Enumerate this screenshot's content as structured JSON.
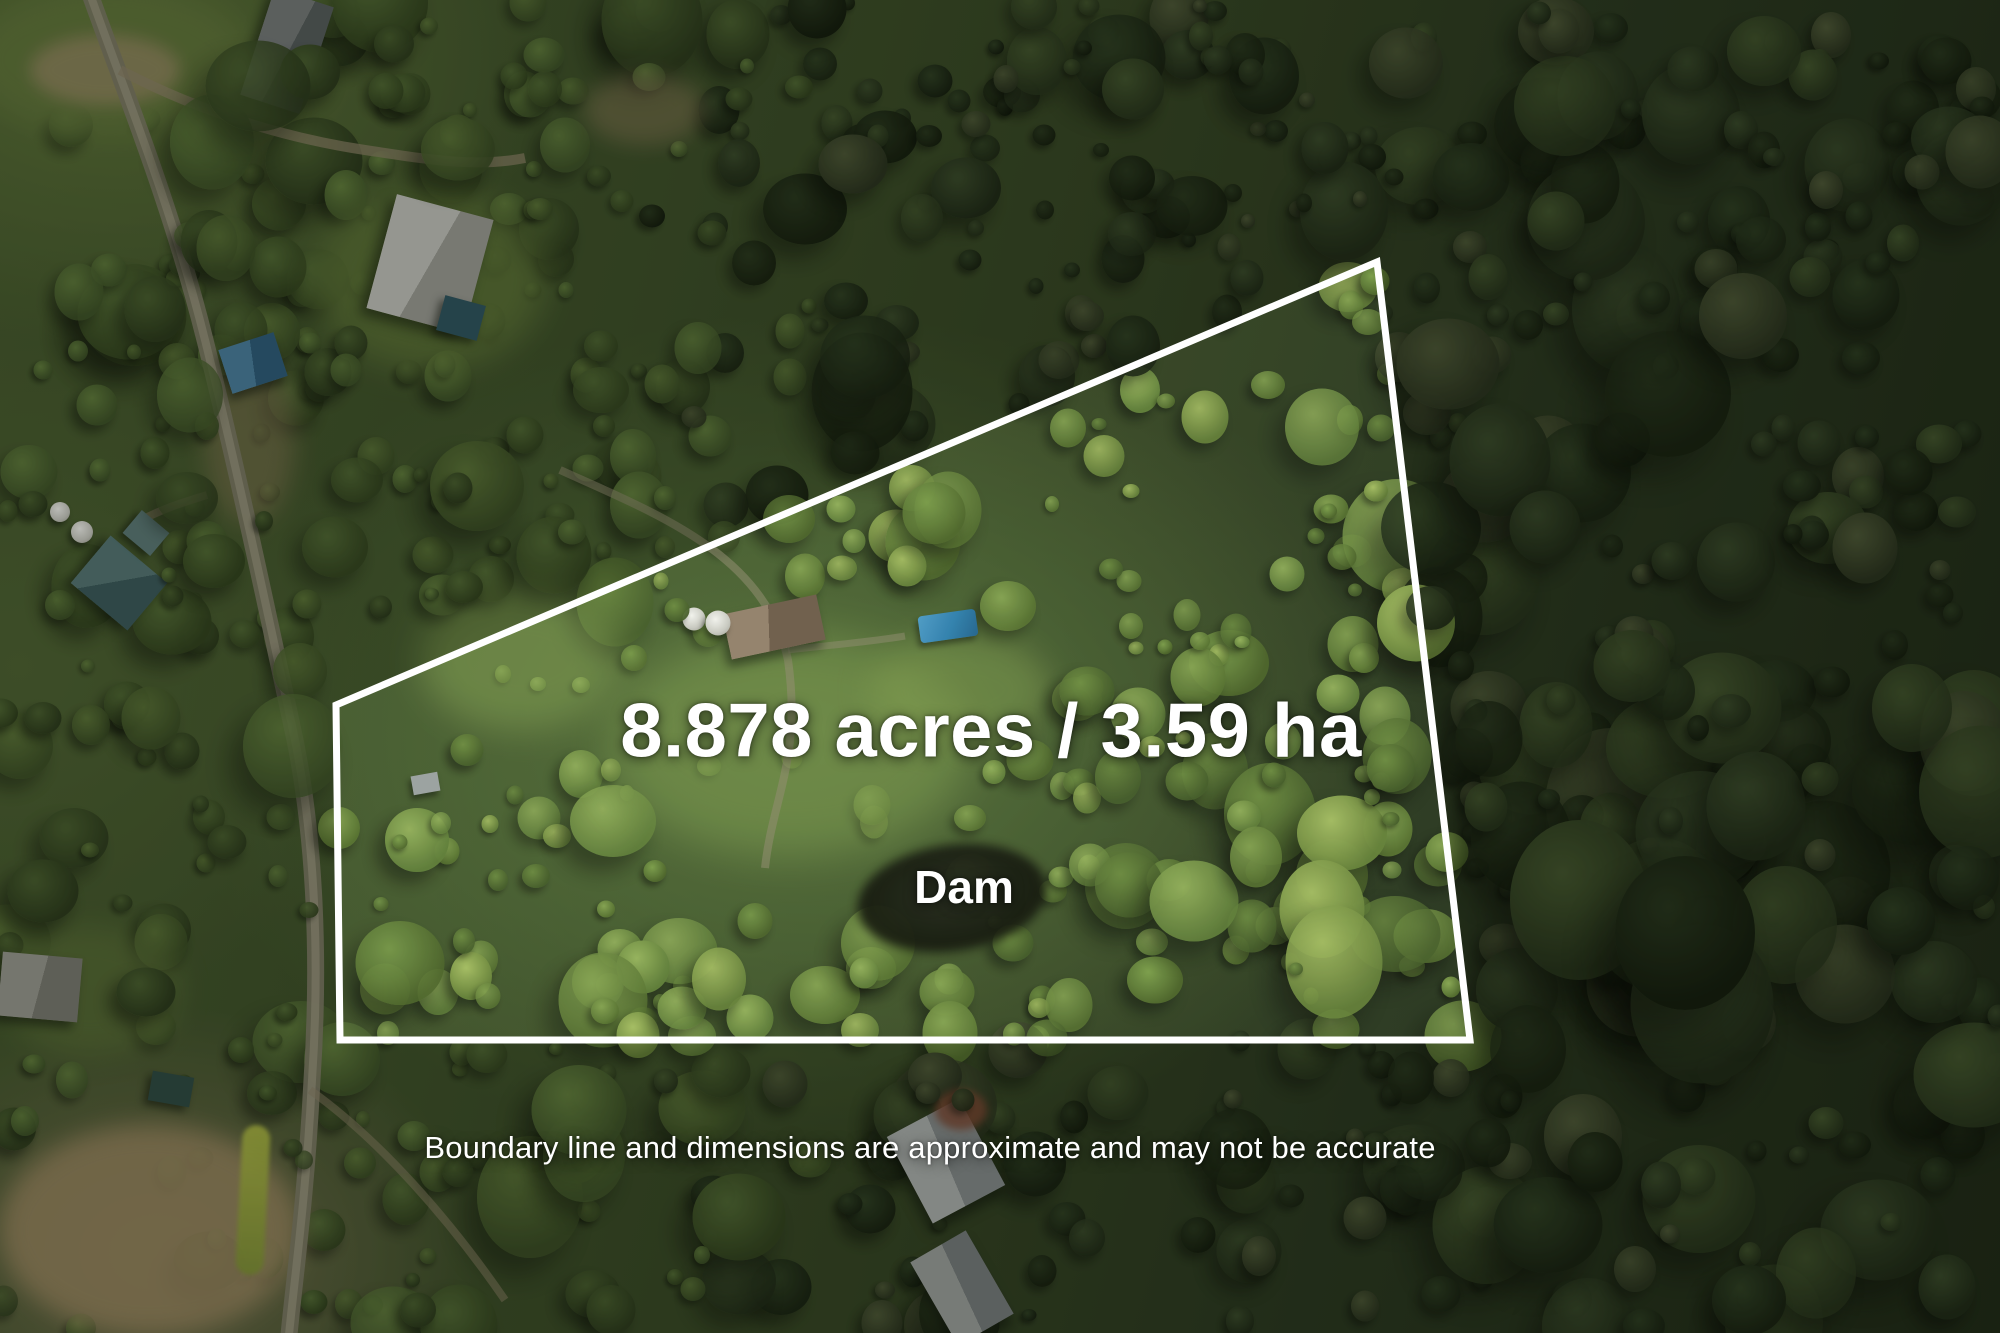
{
  "annotations": {
    "area_label": "8.878 acres / 3.59 ha",
    "dam_label": "Dam",
    "disclaimer": "Boundary line and dimensions are approximate and may not be accurate"
  },
  "boundary": {
    "color": "#ffffff"
  }
}
